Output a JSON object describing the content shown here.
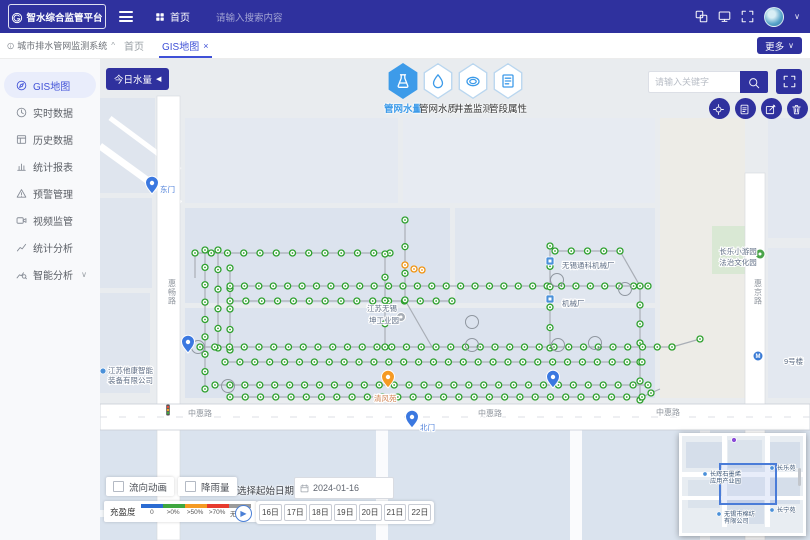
{
  "header": {
    "logo_text": "智水综合监管平台",
    "home_label": "首页",
    "search_placeholder": "请输入搜索内容"
  },
  "tab_bar": {
    "system_title": "城市排水管网监测系统",
    "tabs": [
      {
        "label": "首页",
        "active": false
      },
      {
        "label": "GIS地图",
        "active": true,
        "close": "×"
      }
    ],
    "more_label": "更多"
  },
  "sidebar": {
    "items": [
      {
        "label": "GIS地图",
        "icon": "gis-map-icon",
        "active": true
      },
      {
        "label": "实时数据",
        "icon": "realtime-icon",
        "active": false
      },
      {
        "label": "历史数据",
        "icon": "history-icon",
        "active": false
      },
      {
        "label": "统计报表",
        "icon": "report-icon",
        "active": false
      },
      {
        "label": "预警管理",
        "icon": "warning-icon",
        "active": false
      },
      {
        "label": "视频监管",
        "icon": "video-icon",
        "active": false
      },
      {
        "label": "统计分析",
        "icon": "stat-analysis-icon",
        "active": false
      },
      {
        "label": "智能分析",
        "icon": "smart-analysis-icon",
        "active": false,
        "expandable": true
      }
    ]
  },
  "map_toolbar": {
    "today_water_label": "今日水量",
    "layer_buttons": [
      {
        "label": "管网水量",
        "icon": "water-volume-icon",
        "active": true
      },
      {
        "label": "管网水质",
        "icon": "water-quality-icon",
        "active": false
      },
      {
        "label": "井盖监测",
        "icon": "manhole-icon",
        "active": false
      },
      {
        "label": "管段属性",
        "icon": "pipe-attr-icon",
        "active": false
      }
    ],
    "keyword_placeholder": "请输入关键字",
    "tools": [
      {
        "name": "locate-button",
        "icon": "locate-icon"
      },
      {
        "name": "report-button",
        "icon": "report-doc-icon"
      },
      {
        "name": "annotate-button",
        "icon": "annotate-icon"
      },
      {
        "name": "clear-button",
        "icon": "clear-icon"
      }
    ]
  },
  "map": {
    "accent_colors": {
      "node_green": "#2da02d",
      "node_orange": "#f0930f",
      "pin_blue": "#3b78e0",
      "pin_orange": "#f59a23"
    },
    "pipes": [
      [
        95,
        195,
        290,
        195,
        13
      ],
      [
        105,
        192,
        105,
        331,
        9
      ],
      [
        118,
        192,
        118,
        290,
        6
      ],
      [
        130,
        210,
        130,
        292,
        5
      ],
      [
        130,
        228,
        548,
        228,
        30
      ],
      [
        130,
        243,
        352,
        243,
        15
      ],
      [
        285,
        196,
        285,
        289,
        5
      ],
      [
        305,
        162,
        305,
        242,
        4
      ],
      [
        455,
        193,
        520,
        193,
        5
      ],
      [
        450,
        188,
        450,
        290,
        6
      ],
      [
        540,
        228,
        540,
        342,
        7
      ],
      [
        100,
        289,
        572,
        289,
        33
      ],
      [
        125,
        304,
        542,
        304,
        29
      ],
      [
        115,
        327,
        548,
        327,
        30
      ],
      [
        130,
        339,
        542,
        339,
        28
      ],
      [
        572,
        289,
        600,
        281,
        2
      ],
      [
        305,
        242,
        332,
        289,
        0
      ],
      [
        520,
        193,
        540,
        228,
        0
      ],
      [
        542,
        339,
        560,
        331,
        1
      ],
      [
        95,
        195,
        95,
        220,
        0
      ]
    ],
    "orange_nodes": [
      [
        305,
        207
      ],
      [
        314,
        211
      ],
      [
        322,
        212
      ]
    ],
    "ring_nodes": [
      [
        98,
        289
      ],
      [
        128,
        328
      ],
      [
        372,
        264
      ],
      [
        372,
        287
      ],
      [
        458,
        287
      ],
      [
        457,
        222
      ],
      [
        525,
        231
      ],
      [
        495,
        285
      ]
    ],
    "markers": [
      {
        "type": "pin",
        "color": "#3b78e0",
        "x": 52,
        "y": 136
      },
      {
        "type": "pin",
        "color": "#3b78e0",
        "x": 312,
        "y": 370
      },
      {
        "type": "pin",
        "color": "#3b78e0",
        "x": 88,
        "y": 295
      },
      {
        "type": "pin",
        "color": "#3b78e0",
        "x": 453,
        "y": 330
      },
      {
        "type": "pin",
        "color": "#f59a23",
        "x": 288,
        "y": 330
      },
      {
        "type": "factory",
        "x": 450,
        "y": 203
      },
      {
        "type": "factory",
        "x": 450,
        "y": 241
      },
      {
        "type": "park",
        "x": 660,
        "y": 196
      },
      {
        "type": "poi",
        "x": 301,
        "y": 259
      },
      {
        "type": "metro",
        "x": 658,
        "y": 298
      },
      {
        "type": "traffic",
        "x": 68,
        "y": 352
      },
      {
        "type": "dot-blue",
        "x": 3,
        "y": 313
      }
    ],
    "labels": [
      {
        "text": "东门",
        "x": 60,
        "y": 134,
        "color": "#4a7cd8"
      },
      {
        "text": "北门",
        "x": 320,
        "y": 372,
        "color": "#4a7cd8"
      },
      {
        "text": "清风苑",
        "x": 274,
        "y": 343,
        "color": "#cf7f4e"
      },
      {
        "text": "无锡通科机械厂",
        "x": 462,
        "y": 210
      },
      {
        "text": "机械厂",
        "x": 462,
        "y": 248
      },
      {
        "text": "江苏无锡",
        "x": 282,
        "y": 253,
        "anchor": "middle"
      },
      {
        "text": "坤工业园",
        "x": 284,
        "y": 265,
        "anchor": "middle"
      },
      {
        "text": "长乐小游园",
        "x": 638,
        "y": 196,
        "anchor": "middle"
      },
      {
        "text": "法治文化园",
        "x": 638,
        "y": 207,
        "anchor": "middle"
      },
      {
        "text": "江苏他康智能",
        "x": 8,
        "y": 315
      },
      {
        "text": "装备有限公司",
        "x": 8,
        "y": 325
      },
      {
        "text": "9号楼",
        "x": 684,
        "y": 306
      }
    ],
    "road_labels": [
      {
        "text": "惠畅路",
        "x": 68,
        "y": 228,
        "vertical": true
      },
      {
        "text": "惠京路",
        "x": 654,
        "y": 228,
        "vertical": true
      },
      {
        "text": "中惠路",
        "x": 88,
        "y": 358
      },
      {
        "text": "中惠路",
        "x": 378,
        "y": 358
      },
      {
        "text": "中惠路",
        "x": 556,
        "y": 357
      }
    ]
  },
  "bottom_controls": {
    "flow_animation_label": "流向动画",
    "rainfall_label": "降雨量",
    "legend": {
      "title": "充盈度",
      "items": [
        {
          "label": "0",
          "color": "#2a6bd2"
        },
        {
          "label": ">0%",
          "color": "#3fa73f"
        },
        {
          "label": ">50%",
          "color": "#f59a23"
        },
        {
          "label": ">70%",
          "color": "#e73b2e"
        },
        {
          "label": "无数据",
          "color": "#9b9b9b"
        }
      ]
    },
    "date_picker": {
      "label": "选择起始日期",
      "value": "2024-01-16"
    },
    "day_buttons": [
      "16日",
      "17日",
      "18日",
      "19日",
      "20日",
      "21日",
      "22日"
    ]
  },
  "minimap": {
    "labels": [
      {
        "pin": true,
        "x": 28,
        "y": 40,
        "lines": [
          "长辉石墨烯",
          "应用产业园"
        ]
      },
      {
        "pin": true,
        "x": 95,
        "y": 34,
        "lines": [
          "长乐苑"
        ]
      },
      {
        "pin": true,
        "x": 42,
        "y": 80,
        "lines": [
          "无锡市棉纺",
          "有限公司"
        ]
      },
      {
        "pin": true,
        "x": 95,
        "y": 76,
        "lines": [
          "长宁苑"
        ]
      }
    ]
  }
}
